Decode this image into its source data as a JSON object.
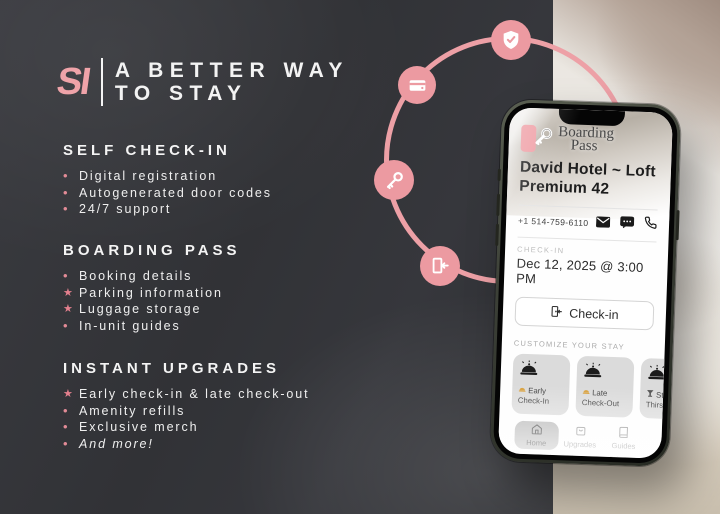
{
  "colors": {
    "accent_pink": "#EC9AA1",
    "panel_dark": "#333438",
    "star_pink": "#E4808E",
    "card_gray": "#DBDBDB",
    "frame_olive": "#3C4037"
  },
  "brand": {
    "logo": "SI"
  },
  "headline": {
    "line1": "A BETTER WAY",
    "line2": "TO STAY"
  },
  "sections": [
    {
      "title": "SELF CHECK-IN",
      "items": [
        {
          "marker": "•",
          "text": "Digital registration"
        },
        {
          "marker": "•",
          "text": "Autogenerated door codes"
        },
        {
          "marker": "•",
          "text": "24/7 support"
        }
      ]
    },
    {
      "title": "BOARDING PASS",
      "items": [
        {
          "marker": "•",
          "text": "Booking details"
        },
        {
          "marker": "★",
          "text": "Parking information"
        },
        {
          "marker": "★",
          "text": "Luggage storage"
        },
        {
          "marker": "•",
          "text": "In-unit guides"
        }
      ]
    },
    {
      "title": "INSTANT UPGRADES",
      "items": [
        {
          "marker": "★",
          "text": "Early check-in & late check-out"
        },
        {
          "marker": "•",
          "text": "Amenity refills"
        },
        {
          "marker": "•",
          "text": "Exclusive merch"
        },
        {
          "marker": "•",
          "text": "And more!"
        }
      ]
    }
  ],
  "ring": {
    "icons": [
      "shield-check",
      "credit-card",
      "key",
      "door-entry"
    ]
  },
  "phone": {
    "app": {
      "logo_line1": "Boarding",
      "logo_line2": "Pass",
      "property_title": "David Hotel ~ Loft Premium 42",
      "phone_number": "+1 514-759-6110",
      "checkin_label": "CHECK-IN",
      "checkin_datetime": "Dec 12, 2025 @ 3:00 PM",
      "checkin_button_label": "Check-in",
      "customize_label": "CUSTOMIZE YOUR STAY",
      "cards": [
        {
          "icon": "bell",
          "line1": "Early",
          "line2": "Check-In"
        },
        {
          "icon": "bell",
          "line1": "Late",
          "line2": "Check-Out"
        },
        {
          "icon": "drink",
          "line1": "Still",
          "line2": "Thirsty"
        }
      ],
      "nav": [
        {
          "label": "Home",
          "active": true
        },
        {
          "label": "Upgrades",
          "active": false
        },
        {
          "label": "Guides",
          "active": false
        }
      ],
      "url": "guest.simplissimmo.ca — Private"
    }
  }
}
